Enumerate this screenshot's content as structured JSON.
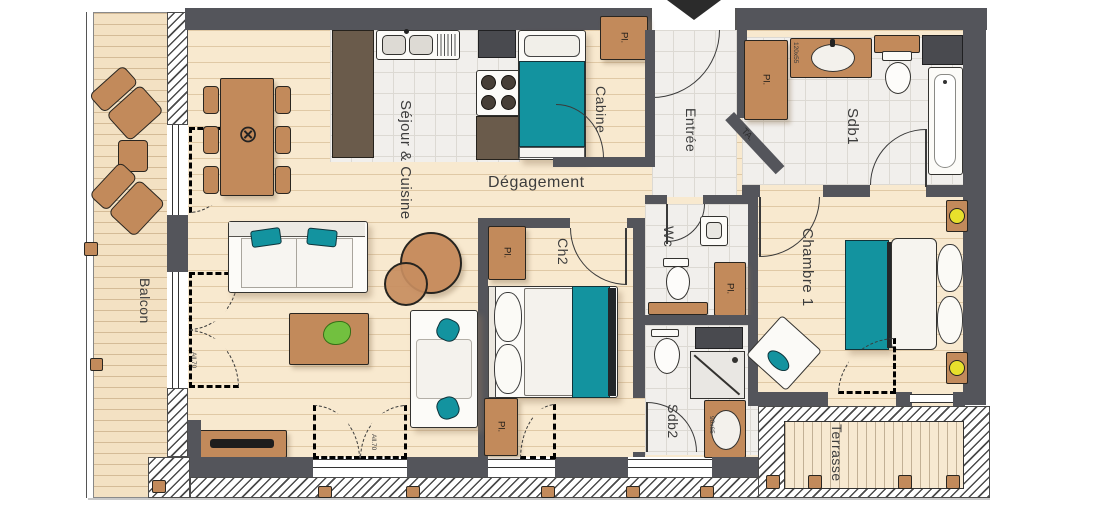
{
  "title": "Apartment floor plan",
  "rooms": {
    "balcon": {
      "label": "Balcon"
    },
    "sejour": {
      "label": "Séjour & Cuisine"
    },
    "cabine": {
      "label": "Cabine"
    },
    "entree": {
      "label": "Entrée"
    },
    "sdb1": {
      "label": "Sdb1"
    },
    "degagement": {
      "label": "Dégagement"
    },
    "ch2": {
      "label": "Ch2"
    },
    "wc": {
      "label": "Wc"
    },
    "chambre1": {
      "label": "Chambre 1"
    },
    "sdb2": {
      "label": "Sdb2"
    },
    "terrasse": {
      "label": "Terrasse"
    }
  },
  "labels": {
    "closet": "Pl.",
    "technical_shaft": "TA.",
    "vanity_sdb1_dim": "120x55",
    "vanity_sdb2_dim": "90x65",
    "window_sill": "All.70",
    "ceiling_light_symbol": "⊗"
  },
  "colors": {
    "wall": "#54555b",
    "wood_floor": "#f8e9cf",
    "tile_floor": "#f1efec",
    "furniture_brown": "#c28a5b",
    "counter_brown": "#6a5b4b",
    "accent_teal": "#13939f",
    "lamp_yellow": "#e7e02c",
    "plant_green": "#72c03f"
  }
}
